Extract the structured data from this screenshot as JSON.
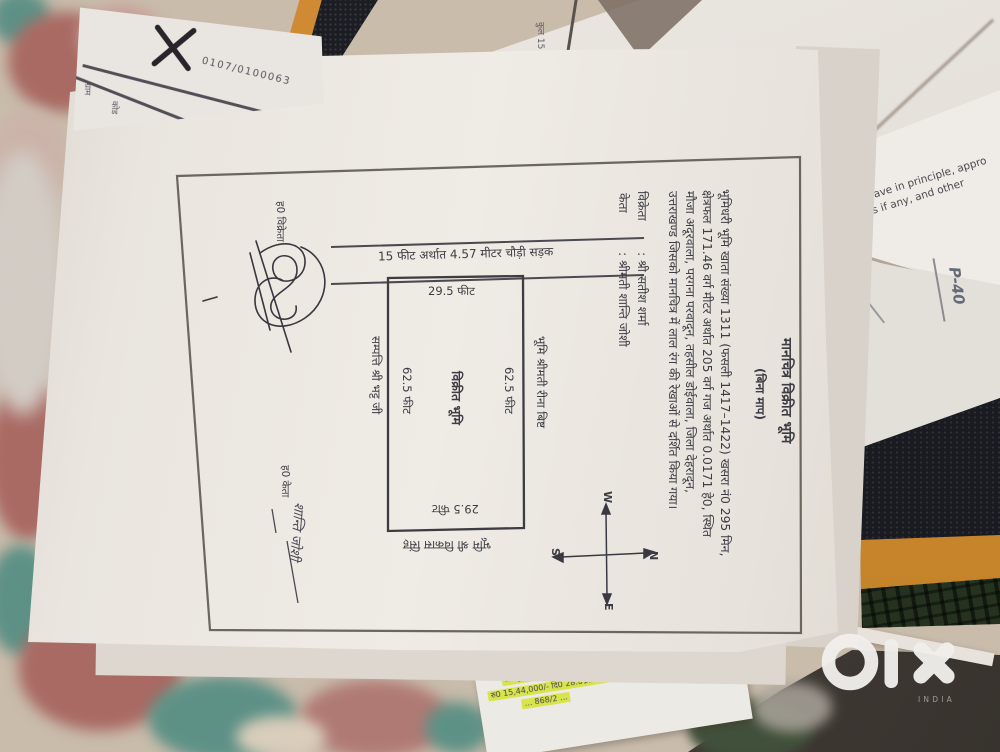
{
  "photo": {
    "watermark": {
      "brand": "olx",
      "country": "INDIA"
    }
  },
  "doc": {
    "title": "मानचित्र विक्रीत भूमि",
    "subtitle": "(बिना माप)",
    "body": [
      "भूमिधरी भूमि खाता संख्या 1311 (फसली 1417–1422) खसरा नं0 295 मिन,",
      "क्षेत्रफल 171.46 वर्ग मीटर अर्थात 205 वर्ग गज अर्थात 0.0171 हे0, स्थित",
      "मौजा अदूरवाला, परगना परवादून, तहसील डोईवाला, जिला देहरादून,",
      "उत्तराखण्ड जिसको मानचित्र में लाल रंग की रेखाओं से दर्शित किया गया।"
    ],
    "parties": {
      "seller_label": "विक्रेता",
      "seller_name": ": श्री सतीश शर्मा",
      "buyer_label": "केता",
      "buyer_name": ": श्रीमती शान्ति जोशी"
    },
    "map": {
      "road": "15 फीट अर्थात 4.57 मीटर चौड़ी सड़क",
      "top_len": "29.5 फीट",
      "bottom_len": "29.5 फीट",
      "left_len": "62.5 फीट",
      "right_len": "62.5 फीट",
      "center": "विक्रीत भूमि",
      "neighbor_right": "भूमि श्रीमती रीना बिष्ट",
      "neighbor_left": "सम्पत्ति श्री भट्ट जी",
      "neighbor_bottom": "भूमि श्री विकास सिंह",
      "compass": {
        "n": "N",
        "s": "S",
        "e": "E",
        "w": "W"
      }
    },
    "signatures": {
      "seller_label": "ह0 विक्रेता",
      "buyer_label": "ह0 केता",
      "buyer_name": "शान्ति जोशी"
    }
  },
  "papers": {
    "receipt": {
      "number": "0107/0100063",
      "mark": "दर्ज",
      "fragments": [
        "ग्राम",
        "कोड"
      ]
    },
    "english_note": {
      "line1": "have in principle, appro",
      "line2": "ns if any, and other"
    },
    "hand_note": "P-40",
    "top_fragment": "कुल 15",
    "green_slip": {
      "lines": [
        "... सं0 295/6",
        "... सिंह बड़ी सिंह फसल ...",
        "... खसरा सं0 हाल 27 रोड ...",
        "... भूमि विक्रय ...",
        "रु0 15,44,000/- दि0 28.01.2015",
        "... 868/2 ..."
      ]
    }
  },
  "palette": {
    "fabric_base": "#c9bcab",
    "fabric_red": "#a96a63",
    "fabric_teal": "#5e9186",
    "paper": "#eae5df",
    "ink": "#3e3c45",
    "highlight_green": "#d8e44c",
    "bag_black": "#191b20",
    "bag_orange": "#d08b2e",
    "floor_brown": "#453f39",
    "watermark_white": "#f1efec"
  }
}
